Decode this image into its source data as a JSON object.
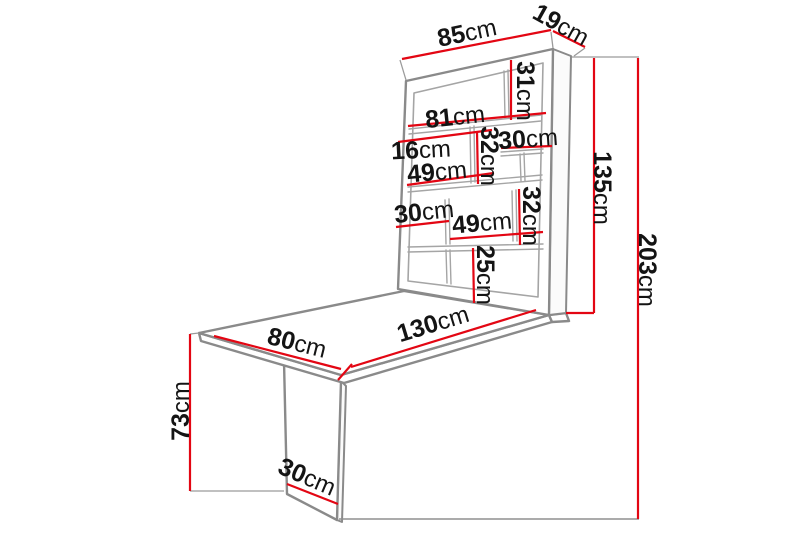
{
  "diagram_type": "furniture-dimension-diagram",
  "colors": {
    "dimension": "#e30613",
    "outline": "#8a8a8a",
    "outline_light": "#a5a5a5",
    "label": "#141414",
    "background": "#ffffff"
  },
  "dimensions": {
    "unit_width": {
      "value": "85",
      "unit": "cm"
    },
    "unit_depth": {
      "value": "19",
      "unit": "cm"
    },
    "top_cubby_height": {
      "value": "31",
      "unit": "cm"
    },
    "inner_width": {
      "value": "81",
      "unit": "cm"
    },
    "inner_depth": {
      "value": "16",
      "unit": "cm"
    },
    "upper_divider_height": {
      "value": "32",
      "unit": "cm"
    },
    "upper_right_cubby": {
      "value": "30",
      "unit": "cm"
    },
    "upper_left_cubby": {
      "value": "49",
      "unit": "cm"
    },
    "middle_left_cubby": {
      "value": "30",
      "unit": "cm"
    },
    "middle_cubby": {
      "value": "49",
      "unit": "cm"
    },
    "middle_divider_height": {
      "value": "32",
      "unit": "cm"
    },
    "bottom_cubby_height": {
      "value": "25",
      "unit": "cm"
    },
    "unit_height": {
      "value": "135",
      "unit": "cm"
    },
    "total_height": {
      "value": "203",
      "unit": "cm"
    },
    "table_width": {
      "value": "80",
      "unit": "cm"
    },
    "table_length": {
      "value": "130",
      "unit": "cm"
    },
    "table_height": {
      "value": "73",
      "unit": "cm"
    },
    "leg_width": {
      "value": "30",
      "unit": "cm"
    }
  }
}
